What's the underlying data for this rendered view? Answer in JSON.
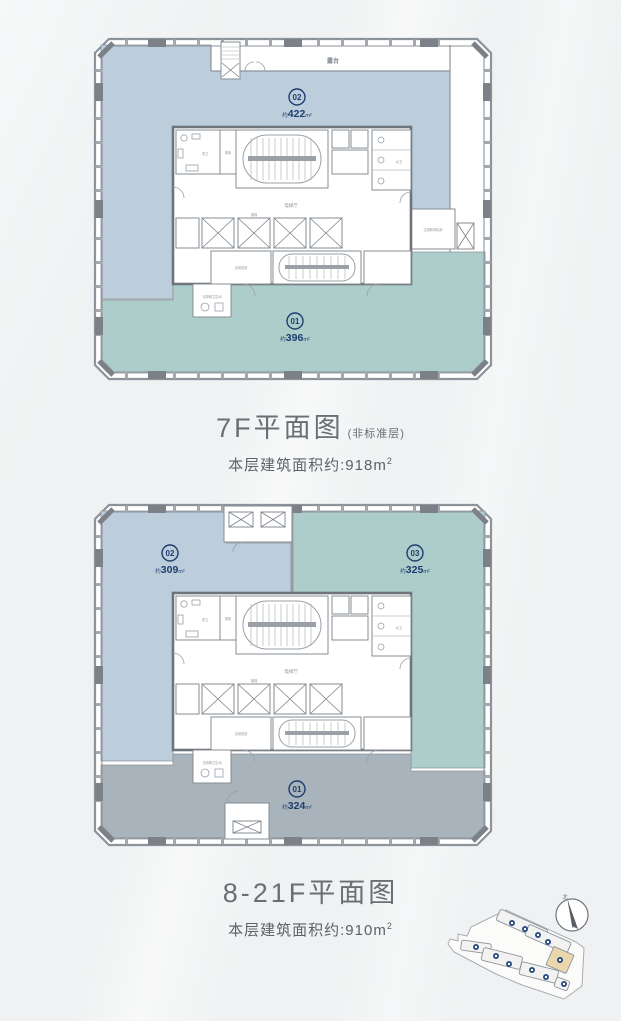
{
  "page": {
    "background": "#eff1f2"
  },
  "plan7": {
    "title": "7F平面图",
    "title_note": "(非标准层)",
    "subtitle": "本层建筑面积约:918m",
    "subtitle_sup": "2",
    "units": {
      "u02": {
        "num": "02",
        "prefix": "约",
        "value": "422",
        "unit": "m²"
      },
      "u01": {
        "num": "01",
        "prefix": "约",
        "value": "396",
        "unit": "m²"
      }
    }
  },
  "plan8": {
    "title": "8-21F平面图",
    "subtitle": "本层建筑面积约:910m",
    "subtitle_sup": "2",
    "units": {
      "u02": {
        "num": "02",
        "prefix": "约",
        "value": "309",
        "unit": "m²"
      },
      "u03": {
        "num": "03",
        "prefix": "约",
        "value": "325",
        "unit": "m²"
      },
      "u01": {
        "num": "01",
        "prefix": "约",
        "value": "324",
        "unit": "m²"
      }
    }
  },
  "rooms": {
    "terrace": "露台",
    "elevator_hall": "电梯厅",
    "shared_lobby": "合用前室",
    "male_wc": "男卫",
    "female_wc": "女卫",
    "accessible_wc": "无障碍卫生间",
    "ac_room": "空调新风机房",
    "lift": "客梯",
    "weak_elec": "弱电"
  },
  "siteplan": {
    "north": "北"
  },
  "colors": {
    "unit_blue": "#bccedc",
    "unit_teal": "#adcdcb",
    "unit_gray": "#a9b3bb",
    "badge_navy": "#1e3e6e",
    "wall": "#6f747b",
    "site_highlight": "#ead7ae"
  }
}
